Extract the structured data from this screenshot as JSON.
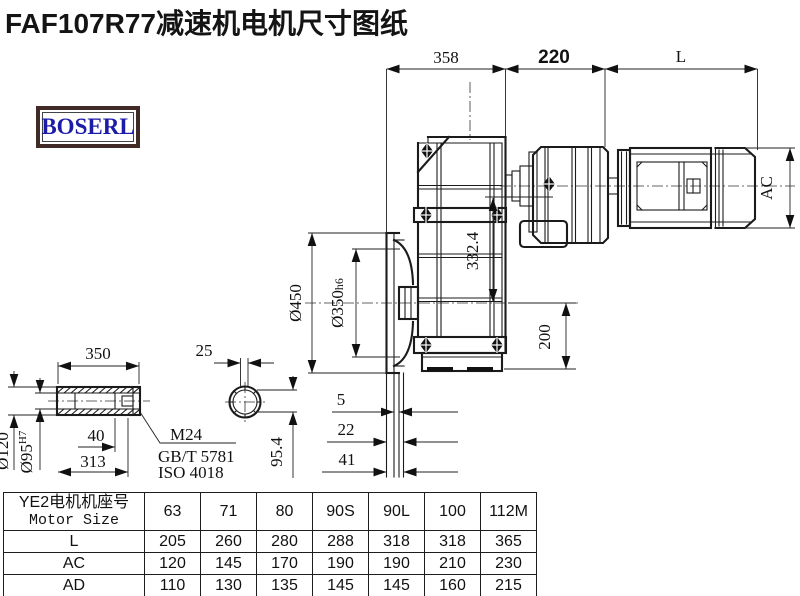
{
  "title": "FAF107R77减速机电机尺寸图纸",
  "logo": {
    "text": "BOSERL"
  },
  "drawing": {
    "dims": {
      "d358": "358",
      "d220": "220",
      "dL": "L",
      "dAC": "AC",
      "d450": "Ø450",
      "d350": "Ø350",
      "d350_suffix": "h6",
      "d332": "332.4",
      "d200": "200",
      "d5": "5",
      "d22": "22",
      "d41": "41",
      "d954": "95.4",
      "d350s": "350",
      "d25": "25",
      "d40": "40",
      "d313": "313",
      "d120": "Ø120",
      "d95": "Ø95",
      "d95_suffix": "H7",
      "thread": "M24",
      "standard1": "GB/T 5781",
      "standard2": "ISO 4018"
    }
  },
  "table": {
    "header_cn": "YE2电机机座号",
    "header_en": "Motor Size",
    "columns": [
      "63",
      "71",
      "80",
      "90S",
      "90L",
      "100",
      "112M"
    ],
    "rows": [
      {
        "label": "L",
        "values": [
          "205",
          "260",
          "280",
          "288",
          "318",
          "318",
          "365"
        ]
      },
      {
        "label": "AC",
        "values": [
          "120",
          "145",
          "170",
          "190",
          "190",
          "210",
          "230"
        ]
      },
      {
        "label": "AD",
        "values": [
          "110",
          "130",
          "135",
          "145",
          "145",
          "160",
          "215"
        ]
      }
    ]
  }
}
